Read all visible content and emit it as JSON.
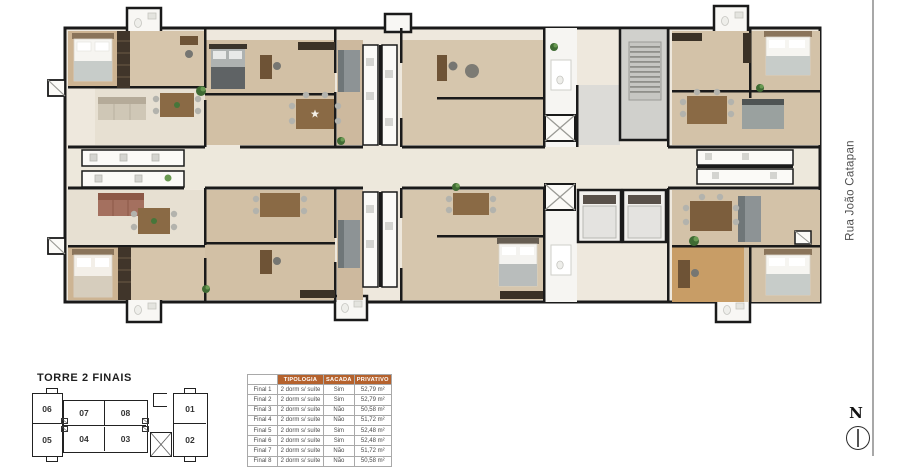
{
  "title": "TORRE 2 FINAIS",
  "street": {
    "name": "Rua João Catapan"
  },
  "compass": {
    "label": "N"
  },
  "key_plan": {
    "top": [
      "06",
      "07",
      "08",
      "01"
    ],
    "bottom": [
      "05",
      "04",
      "03",
      "02"
    ]
  },
  "units_table": {
    "headers": [
      "",
      "TIPOLOGIA",
      "SACADA",
      "PRIVATIVO"
    ],
    "rows": [
      {
        "final": "Final 1",
        "tipologia": "2 dorm s/ suíte",
        "sacada": "Sim",
        "privativo": "52,79 m²"
      },
      {
        "final": "Final 2",
        "tipologia": "2 dorm s/ suíte",
        "sacada": "Sim",
        "privativo": "52,79 m²"
      },
      {
        "final": "Final 3",
        "tipologia": "2 dorm s/ suíte",
        "sacada": "Não",
        "privativo": "50,58 m²"
      },
      {
        "final": "Final 4",
        "tipologia": "2 dorm s/ suíte",
        "sacada": "Não",
        "privativo": "51,72 m²"
      },
      {
        "final": "Final 5",
        "tipologia": "2 dorm s/ suíte",
        "sacada": "Sim",
        "privativo": "52,48 m²"
      },
      {
        "final": "Final 6",
        "tipologia": "2 dorm s/ suíte",
        "sacada": "Sim",
        "privativo": "52,48 m²"
      },
      {
        "final": "Final 7",
        "tipologia": "2 dorm s/ suíte",
        "sacada": "Não",
        "privativo": "51,72 m²"
      },
      {
        "final": "Final 8",
        "tipologia": "2 dorm s/ suíte",
        "sacada": "Não",
        "privativo": "50,58 m²"
      }
    ]
  },
  "colors": {
    "table_header_orange": "#b5622d",
    "walls": "#1a1a1a",
    "wood_floor": "#cdb493",
    "street_line": "#a8a8a8"
  }
}
